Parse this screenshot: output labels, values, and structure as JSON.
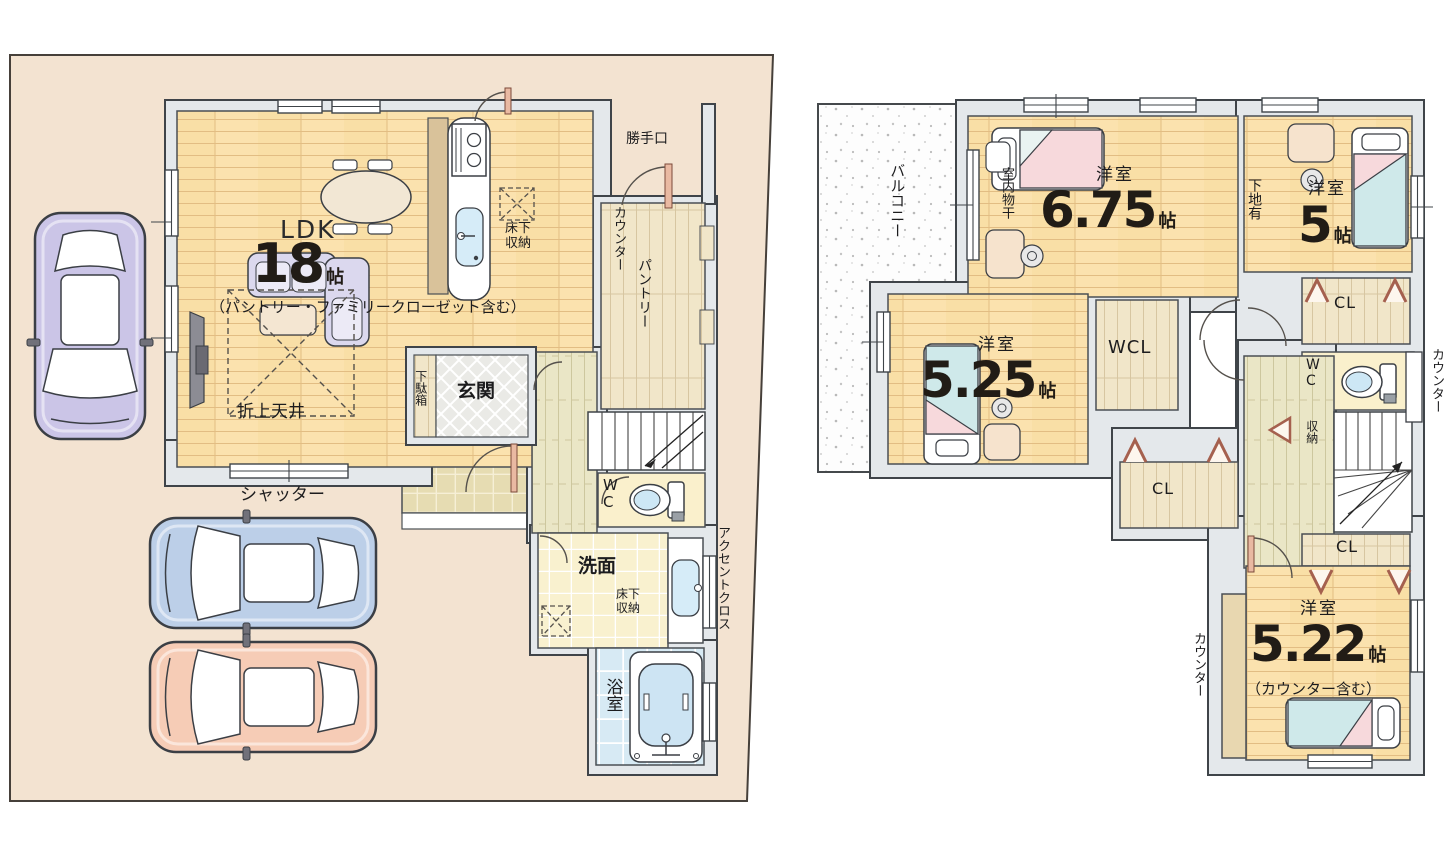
{
  "floor1": {
    "shutter_label": "シャッター",
    "ldk_label": "LDK",
    "ldk_size": "18",
    "ldk_unit": "帖",
    "ldk_note": "（パントリー・ファミリークローゼット含む）",
    "coffered_ceiling": "折上天井",
    "underfloor_storage_kitchen": "床下\n収納",
    "back_door": "勝手口",
    "counter_label": "カウンター",
    "pantry": "パントリー",
    "entrance": "玄関",
    "shoe_cabinet": "下駄箱",
    "wc": "W\nC",
    "washroom": "洗面",
    "underfloor_storage_washroom": "床下\n収納",
    "bathroom": "浴室",
    "accent_cloth": "アクセントクロス"
  },
  "floor2": {
    "balcony": "バルコニー",
    "indoor_laundry": "室内物干",
    "room_675_type": "洋室",
    "room_675_size": "6.75",
    "room_675_unit": "帖",
    "wall_backing": "下地有",
    "room_5_type": "洋室",
    "room_5_size": "5",
    "room_5_unit": "帖",
    "closet_upper_right": "CL",
    "wc": "W\nC",
    "counter_right": "カウンター",
    "walk_in_closet": "WCL",
    "room_525_type": "洋室",
    "room_525_size": "5.25",
    "room_525_unit": "帖",
    "storage": "収納",
    "closet_middle": "CL",
    "closet_lower": "CL",
    "room_522_type": "洋室",
    "room_522_size": "5.22",
    "room_522_unit": "帖",
    "room_522_note": "（カウンター含む）",
    "counter_left": "カウンター"
  },
  "colors": {
    "site": "#f3e3d1",
    "wood_floor": "#fbe2ae",
    "wall_fill": "#e4e8eb",
    "wall_line": "#3f4449",
    "washroom_floor": "#f9f1cf",
    "bath_blue": "#d7eaf4",
    "bed_pink": "#f7d9dc",
    "bed_blue": "#cfe9ea",
    "car_purple": "#cbc5e7",
    "car_blue": "#bccfe8",
    "car_pink": "#f6ccb6"
  }
}
